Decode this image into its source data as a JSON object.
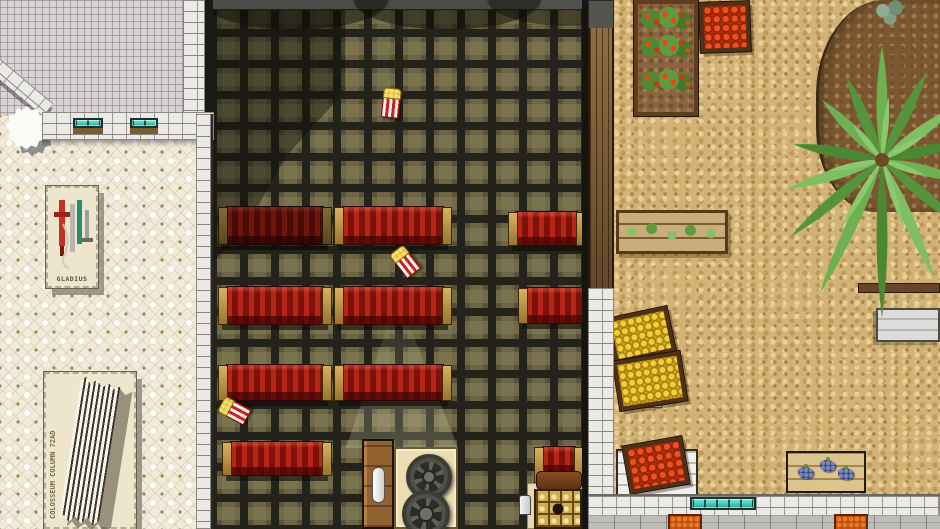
{
  "scene": {
    "labels": {
      "gladius": "GLADIUS",
      "column": "COLOSSEUM COLUMN 72AD"
    },
    "palette": {
      "theater_floor": "#57533a",
      "bench_red": "#b82418",
      "bench_wood": "#c9a24e",
      "museum_floor": "#f1ebdb",
      "cobblestone": "#d3b277",
      "window_teal": "#2fc4b2",
      "soil": "#8a6540",
      "palm_green": "#6fb052",
      "tomato_red": "#ef5020",
      "lemon_yellow": "#f2cf3a",
      "grape_blue": "#3c4c7e"
    },
    "benches": [
      {
        "x": 218,
        "y": 206,
        "w": 114,
        "h": 46,
        "shade": true
      },
      {
        "x": 334,
        "y": 206,
        "w": 118,
        "h": 46
      },
      {
        "x": 508,
        "y": 211,
        "w": 78,
        "h": 42
      },
      {
        "x": 218,
        "y": 286,
        "w": 114,
        "h": 46
      },
      {
        "x": 334,
        "y": 286,
        "w": 118,
        "h": 46
      },
      {
        "x": 518,
        "y": 287,
        "w": 76,
        "h": 44
      },
      {
        "x": 218,
        "y": 364,
        "w": 114,
        "h": 44
      },
      {
        "x": 334,
        "y": 364,
        "w": 118,
        "h": 44
      },
      {
        "x": 222,
        "y": 441,
        "w": 110,
        "h": 42
      },
      {
        "x": 534,
        "y": 446,
        "w": 50,
        "h": 44,
        "back": true
      }
    ],
    "popcorn": [
      {
        "x": 382,
        "y": 94,
        "r": 6
      },
      {
        "x": 398,
        "y": 252,
        "r": -38
      },
      {
        "x": 228,
        "y": 400,
        "r": -62
      }
    ],
    "crates": [
      {
        "kind": "tomatoes",
        "x": 700,
        "y": 2,
        "w": 50,
        "h": 50,
        "r": -2
      },
      {
        "kind": "lemons",
        "x": 610,
        "y": 312,
        "w": 62,
        "h": 46,
        "r": -12
      },
      {
        "kind": "lemons",
        "x": 616,
        "y": 356,
        "w": 68,
        "h": 50,
        "r": -9
      },
      {
        "kind": "tomatoes",
        "x": 626,
        "y": 441,
        "w": 60,
        "h": 48,
        "r": -10
      }
    ],
    "windows": [
      {
        "x": 73,
        "y": 118,
        "w": 30,
        "h": 10
      },
      {
        "x": 130,
        "y": 118,
        "w": 28,
        "h": 10
      },
      {
        "x": 690,
        "y": 497,
        "w": 66,
        "h": 13
      }
    ],
    "pots": [
      {
        "x": 668,
        "y": 514,
        "w": 34,
        "h": 15
      },
      {
        "x": 834,
        "y": 514,
        "w": 34,
        "h": 15
      }
    ],
    "grapes": [
      {
        "x": 10,
        "y": 14
      },
      {
        "x": 32,
        "y": 7
      },
      {
        "x": 50,
        "y": 15
      }
    ],
    "palm": {
      "cx": 112,
      "cy": 150,
      "fronds": [
        {
          "a": -90,
          "l": 115
        },
        {
          "a": -63,
          "l": 100
        },
        {
          "a": -36,
          "l": 92
        },
        {
          "a": -12,
          "l": 80
        },
        {
          "a": 14,
          "l": 85
        },
        {
          "a": 40,
          "l": 105
        },
        {
          "a": 66,
          "l": 130
        },
        {
          "a": 90,
          "l": 158
        },
        {
          "a": 115,
          "l": 148
        },
        {
          "a": 140,
          "l": 120
        },
        {
          "a": 163,
          "l": 100
        },
        {
          "a": -170,
          "l": 90
        },
        {
          "a": -135,
          "l": 85
        },
        {
          "a": -113,
          "l": 90
        }
      ],
      "colors": [
        "#6fb052",
        "#55943c",
        "#7fbf63",
        "#4c8834"
      ],
      "highlight": "#8cc96e",
      "trunk": "#6b4a26"
    }
  }
}
